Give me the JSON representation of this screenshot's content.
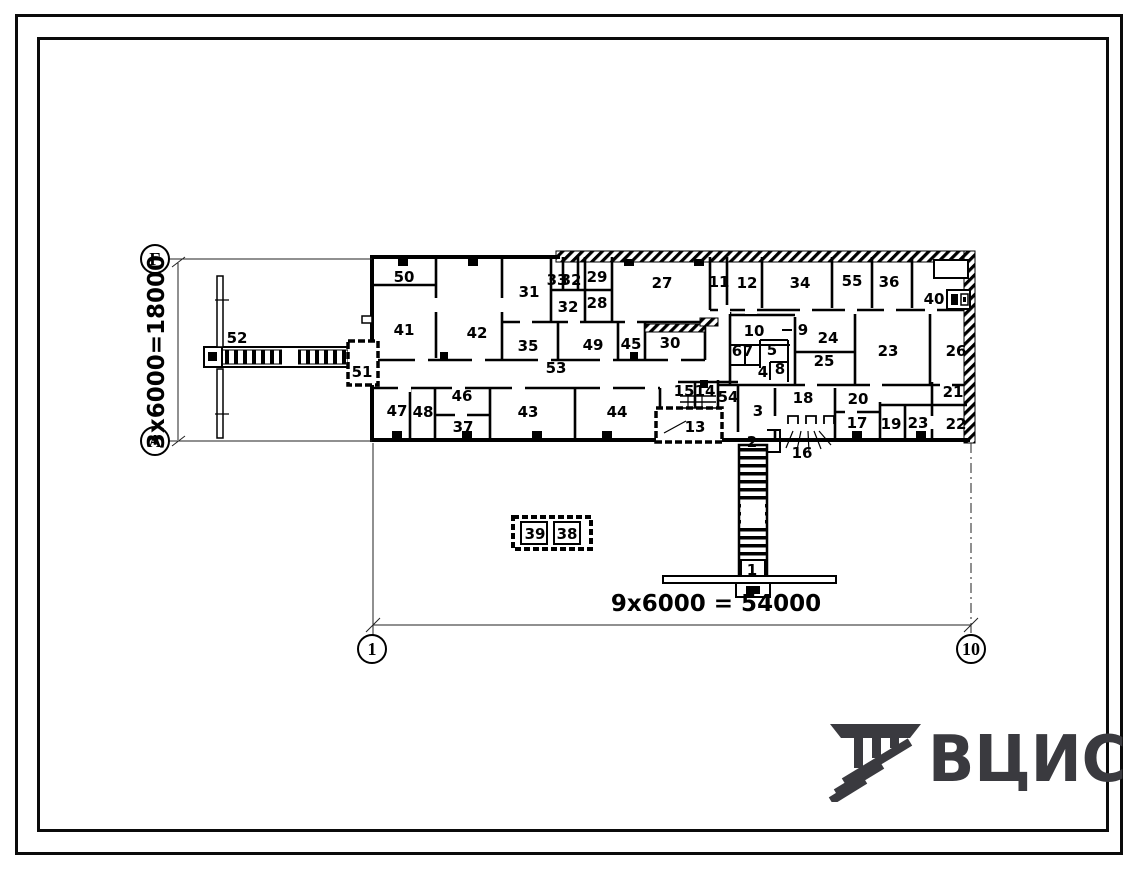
{
  "drawing": {
    "axis_markers": {
      "row_top": "Г",
      "row_bottom": "А",
      "col_left": "1",
      "col_right": "10"
    },
    "dimensions": {
      "vertical": "3x6000=18000",
      "horizontal": "9x6000 = 54000"
    },
    "room_labels": [
      {
        "n": "50",
        "x": 404,
        "y": 282
      },
      {
        "n": "41",
        "x": 404,
        "y": 335
      },
      {
        "n": "42",
        "x": 477,
        "y": 338
      },
      {
        "n": "31",
        "x": 529,
        "y": 297
      },
      {
        "n": "33",
        "x": 557,
        "y": 285,
        "fs": 11
      },
      {
        "n": "32",
        "x": 571,
        "y": 285,
        "fs": 11
      },
      {
        "n": "29",
        "x": 597,
        "y": 282,
        "fs": 13
      },
      {
        "n": "32",
        "x": 568,
        "y": 312
      },
      {
        "n": "28",
        "x": 597,
        "y": 308
      },
      {
        "n": "27",
        "x": 662,
        "y": 288
      },
      {
        "n": "11",
        "x": 719,
        "y": 287,
        "fs": 12
      },
      {
        "n": "12",
        "x": 747,
        "y": 288
      },
      {
        "n": "34",
        "x": 800,
        "y": 288
      },
      {
        "n": "55",
        "x": 852,
        "y": 286
      },
      {
        "n": "36",
        "x": 889,
        "y": 287
      },
      {
        "n": "40",
        "x": 934,
        "y": 304
      },
      {
        "n": "35",
        "x": 528,
        "y": 351
      },
      {
        "n": "49",
        "x": 593,
        "y": 350
      },
      {
        "n": "45",
        "x": 631,
        "y": 349,
        "fs": 13
      },
      {
        "n": "30",
        "x": 670,
        "y": 348
      },
      {
        "n": "53",
        "x": 556,
        "y": 373
      },
      {
        "n": "10",
        "x": 754,
        "y": 336,
        "fs": 13
      },
      {
        "n": "9",
        "x": 803,
        "y": 335,
        "fs": 13
      },
      {
        "n": "24",
        "x": 828,
        "y": 343
      },
      {
        "n": "25",
        "x": 824,
        "y": 366
      },
      {
        "n": "23",
        "x": 888,
        "y": 356
      },
      {
        "n": "26",
        "x": 956,
        "y": 356
      },
      {
        "n": "6",
        "x": 737,
        "y": 356,
        "fs": 11
      },
      {
        "n": "7",
        "x": 748,
        "y": 356,
        "fs": 11
      },
      {
        "n": "5",
        "x": 772,
        "y": 355,
        "fs": 12
      },
      {
        "n": "4",
        "x": 763,
        "y": 377,
        "fs": 12
      },
      {
        "n": "8",
        "x": 780,
        "y": 374,
        "fs": 11
      },
      {
        "n": "47",
        "x": 397,
        "y": 416
      },
      {
        "n": "48",
        "x": 423,
        "y": 417
      },
      {
        "n": "46",
        "x": 462,
        "y": 401
      },
      {
        "n": "37",
        "x": 463,
        "y": 432
      },
      {
        "n": "43",
        "x": 528,
        "y": 417
      },
      {
        "n": "44",
        "x": 617,
        "y": 417
      },
      {
        "n": "15",
        "x": 684,
        "y": 396,
        "fs": 12
      },
      {
        "n": "14",
        "x": 705,
        "y": 396,
        "fs": 12
      },
      {
        "n": "54",
        "x": 728,
        "y": 402,
        "fs": 13
      },
      {
        "n": "13",
        "x": 695,
        "y": 432
      },
      {
        "n": "3",
        "x": 758,
        "y": 416
      },
      {
        "n": "18",
        "x": 803,
        "y": 403
      },
      {
        "n": "20",
        "x": 858,
        "y": 404
      },
      {
        "n": "17",
        "x": 857,
        "y": 428,
        "fs": 13
      },
      {
        "n": "19",
        "x": 891,
        "y": 429
      },
      {
        "n": "23",
        "x": 918,
        "y": 428,
        "fs": 13
      },
      {
        "n": "21",
        "x": 953,
        "y": 397,
        "fs": 13
      },
      {
        "n": "22",
        "x": 956,
        "y": 429
      },
      {
        "n": "2",
        "x": 752,
        "y": 447,
        "fs": 13
      },
      {
        "n": "16",
        "x": 802,
        "y": 458
      },
      {
        "n": "1",
        "x": 752,
        "y": 575,
        "fs": 13
      },
      {
        "n": "51",
        "x": 362,
        "y": 377,
        "fs": 12
      },
      {
        "n": "52",
        "x": 237,
        "y": 343
      },
      {
        "n": "39",
        "x": 535,
        "y": 539
      },
      {
        "n": "38",
        "x": 567,
        "y": 539
      }
    ]
  },
  "logo": {
    "text": "ВЦИС"
  }
}
